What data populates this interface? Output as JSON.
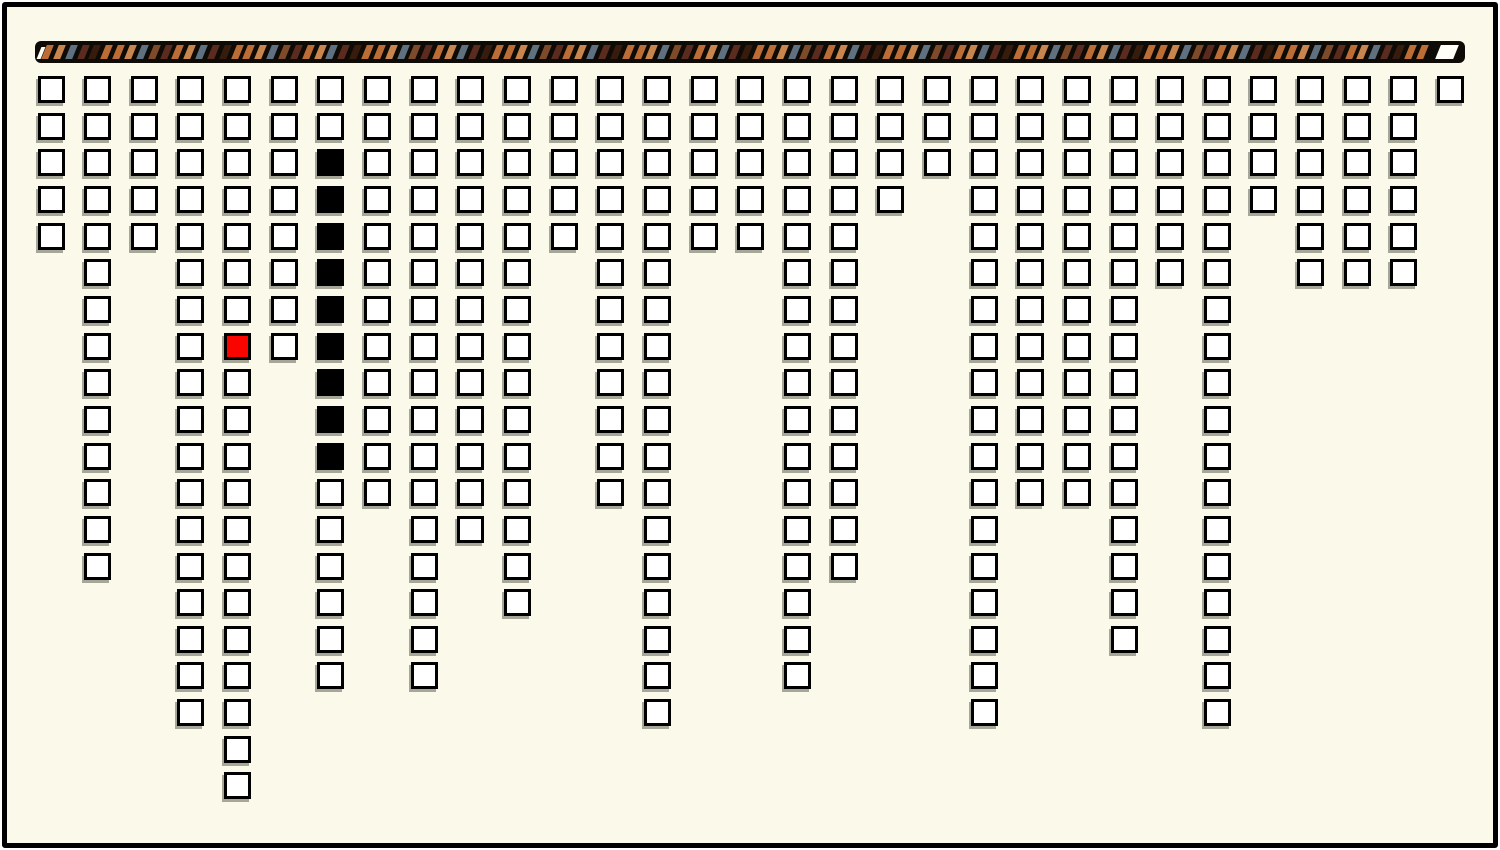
{
  "scene": {
    "page_background": "#ffffff",
    "board_background": "#fbfaea",
    "frame_color": "#000000"
  },
  "progress_bar": {
    "bar_background": "#0e0b06",
    "start_notch_color": "#fffef6",
    "end_segment_color": "#fffef6",
    "stripe_palette": {
      "orange": "#bc6d36",
      "light_orange": "#c8854e",
      "slate": "#5f7080",
      "brown": "#7d4a2a",
      "maroon": "#5a2b1e",
      "dark_brown": "#371c0e"
    },
    "stripe_pattern": [
      "orange",
      "light_orange",
      "slate",
      "maroon",
      "dark_brown",
      "orange",
      "orange",
      "light_orange",
      "slate",
      "brown",
      "maroon"
    ]
  },
  "chart_data": {
    "type": "grid-columns",
    "title": "",
    "num_columns": 31,
    "max_rows": 20,
    "column_heights": [
      5,
      14,
      5,
      18,
      20,
      8,
      17,
      12,
      17,
      13,
      15,
      5,
      12,
      18,
      5,
      5,
      17,
      14,
      4,
      3,
      18,
      12,
      12,
      16,
      6,
      18,
      4,
      6,
      6,
      6,
      1
    ],
    "red_cell": {
      "col": 5,
      "row": 8,
      "color": "#fa0400"
    },
    "black_run": {
      "col": 7,
      "row_start": 3,
      "row_end": 11,
      "color": "#000000"
    },
    "square_fill": "#ffffff",
    "square_border": "#000000"
  }
}
